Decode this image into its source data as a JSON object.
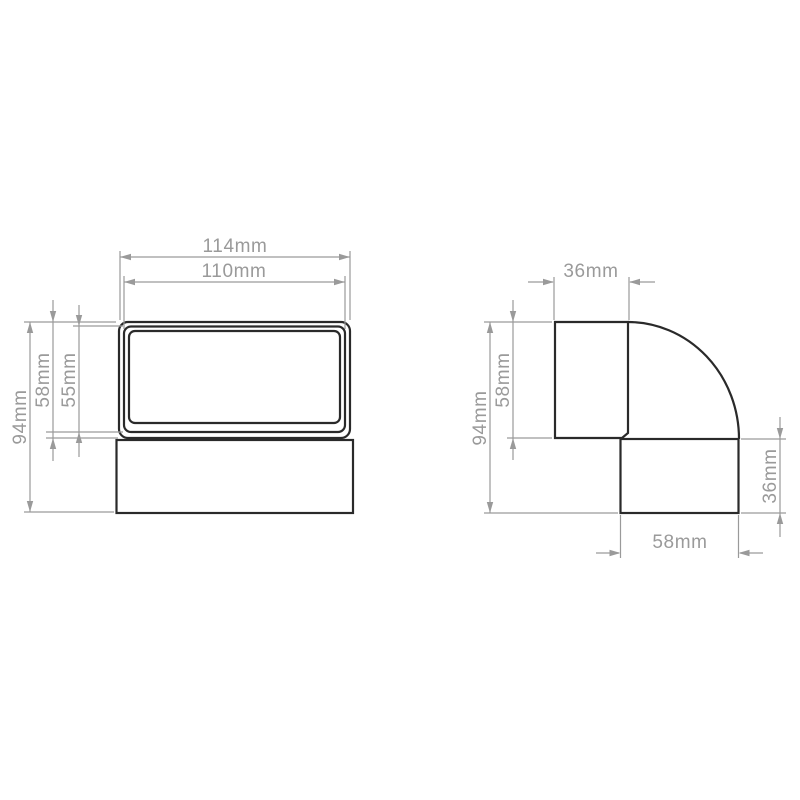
{
  "page": {
    "background": "#ffffff"
  },
  "colors": {
    "outline": "#2a2a2a",
    "dimension": "#9a9a9a"
  },
  "views": {
    "front": {
      "dims": {
        "outer_width": "114mm",
        "inner_width": "110mm",
        "total_height": "94mm",
        "socket_height": "58mm",
        "inner_height": "55mm"
      }
    },
    "side": {
      "dims": {
        "top_width": "36mm",
        "total_height": "94mm",
        "socket_height": "58mm",
        "outlet_height": "36mm",
        "outlet_length": "58mm"
      }
    }
  }
}
